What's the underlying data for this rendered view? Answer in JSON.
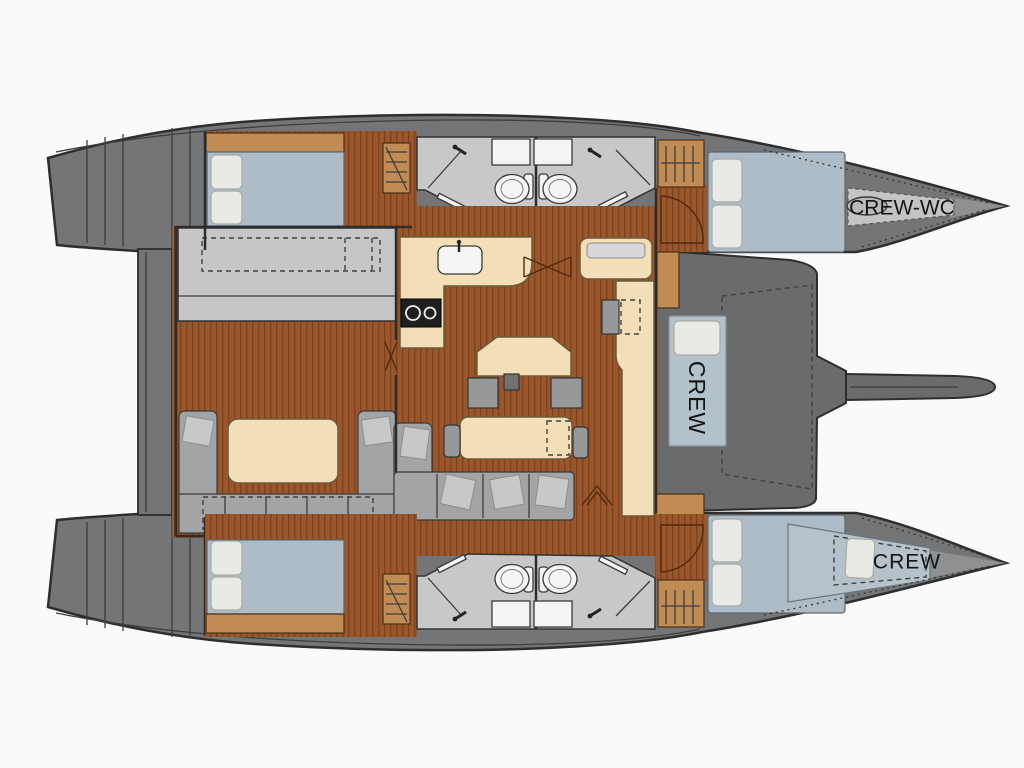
{
  "labels": {
    "crew_wc_bow_top": "CREW-WC",
    "crew_berth_mid": "CREW",
    "crew_bow_bottom": "CREW"
  },
  "colors": {
    "background": "#fafafa",
    "hull-gray": "#737577",
    "hull-outline": "#2d2e2f",
    "foredeck-gray": "#696b6d",
    "wood": "#9a572b",
    "wood-stripe": "#7b431f",
    "tan": "#c18c53",
    "cream": "#f2dfb8",
    "cream-outline": "#6b5b3a",
    "mattress-blue": "#adbcc6",
    "berth-blue": "#b3c1cb",
    "bow-berth-gray": "#c3c5c5",
    "pillow": "#e9eae6",
    "bath-floor": "#c6c8c9",
    "fixture-white": "#f4f4f2",
    "sofa-gray": "#a2a4a6",
    "cushion-gray": "#c6c8ca",
    "room-floor-gray": "#c5c6c8",
    "seat-gray": "#96989a",
    "text": "#141414"
  }
}
